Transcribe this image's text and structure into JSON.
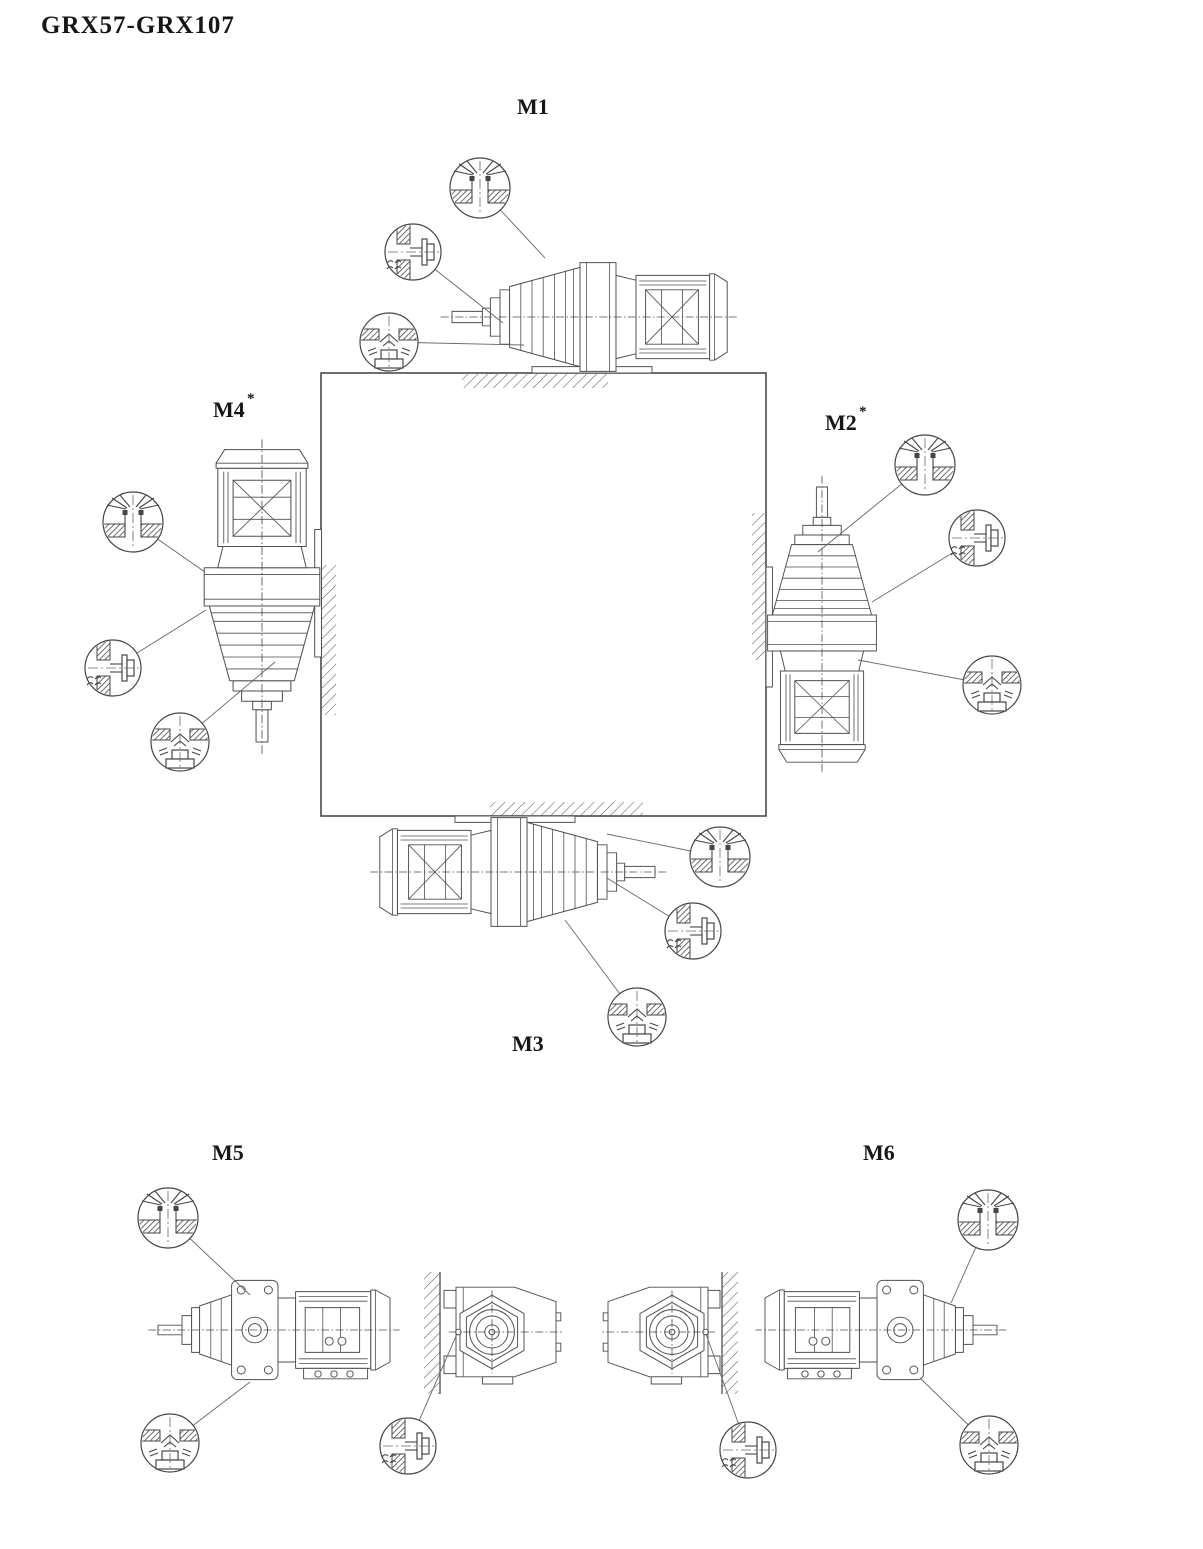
{
  "title": "GRX57-GRX107",
  "positions": {
    "m1": {
      "label": "M1",
      "suffix": ""
    },
    "m2": {
      "label": "M2",
      "suffix": "*"
    },
    "m3": {
      "label": "M3",
      "suffix": ""
    },
    "m4": {
      "label": "M4",
      "suffix": "*"
    },
    "m5": {
      "label": "M5",
      "suffix": ""
    },
    "m6": {
      "label": "M6",
      "suffix": ""
    }
  },
  "symbols": {
    "breather": "breather-plug-icon",
    "oil_level": "oil-level-plug-icon",
    "drain": "oil-drain-plug-icon"
  },
  "colors": {
    "line": "#4f4f4f",
    "text": "#161616",
    "background": "#ffffff"
  }
}
